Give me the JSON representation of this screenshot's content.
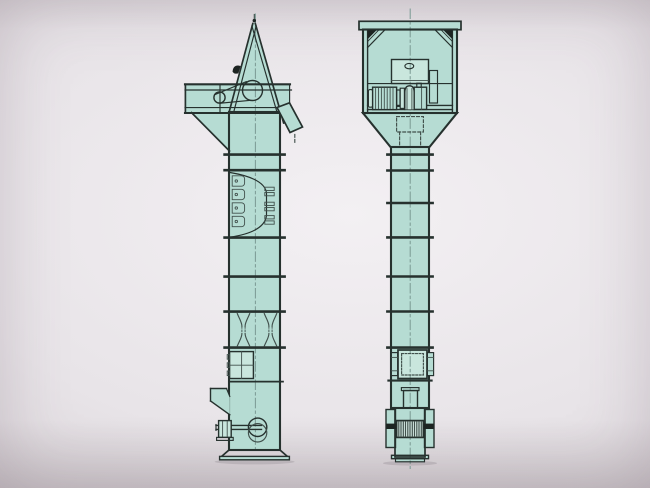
{
  "image": {
    "description": "Scanned engineering drawing of a bucket elevator shown in two orthographic views: side elevation on the left, front elevation on the right",
    "width": 650,
    "height": 488
  },
  "colors": {
    "bg-center": "#f3f0f3",
    "bg-mid": "#e8e4e8",
    "bg-edge": "#d5cfd3",
    "fill": "#b6dcd3",
    "fill-light": "#c9e6dd",
    "fill-lighter": "#d3e8e1",
    "line": "#26312e",
    "line-soft": "#41504c",
    "centerline": "#7d9c96",
    "dark": "#1d2422"
  }
}
